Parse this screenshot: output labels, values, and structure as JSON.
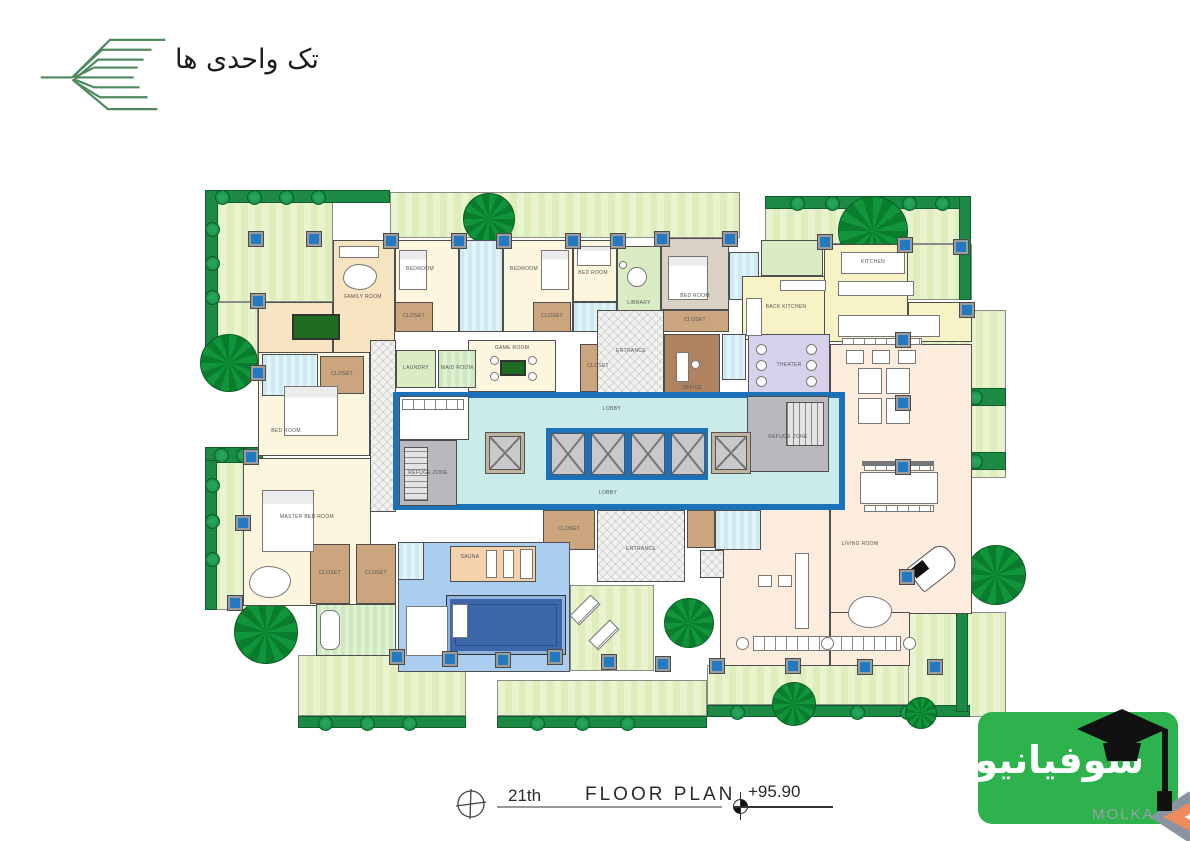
{
  "header": {
    "brand": "تک واحدی ها"
  },
  "title_block": {
    "floor": "21th",
    "title": "FLOOR PLAN",
    "elevation": "+95.90"
  },
  "watermark": {
    "name": "سوفیانیوز",
    "partner": "MOLKA"
  },
  "plan": {
    "labels": {
      "family_room": "FAMILY ROOM",
      "bedroom": "BEDROOM",
      "bed_room": "BED ROOM",
      "master_bedroom": "MASTER BED ROOM",
      "closet": "CLOSET",
      "game_room": "GAME ROOM",
      "library": "LIBRARY",
      "laundry": "LAUNDRY",
      "maid_room": "MAID ROOM",
      "back_kitchen": "BACK KITCHEN",
      "kitchen": "KITCHEN",
      "living_room": "LIVING ROOM",
      "lobby": "LOBBY",
      "refuge_zone": "REFUGE ZONE",
      "entrance": "ENTRANCE",
      "theater": "THEATER",
      "office": "OFFICE",
      "sauna": "SAUNA"
    },
    "colors": {
      "terrace_green": "#e9f4cf",
      "hedge_green": "#1c8a44",
      "tree_green": "#0d8f36",
      "column_blue": "#2379c2",
      "core_wall_blue": "#1b72b8",
      "lobby_cyan": "#c9ebe9",
      "pool_blue": "#3c68ab",
      "watermark_green": "#2db24d",
      "logo_green": "#4f8a5f"
    }
  }
}
